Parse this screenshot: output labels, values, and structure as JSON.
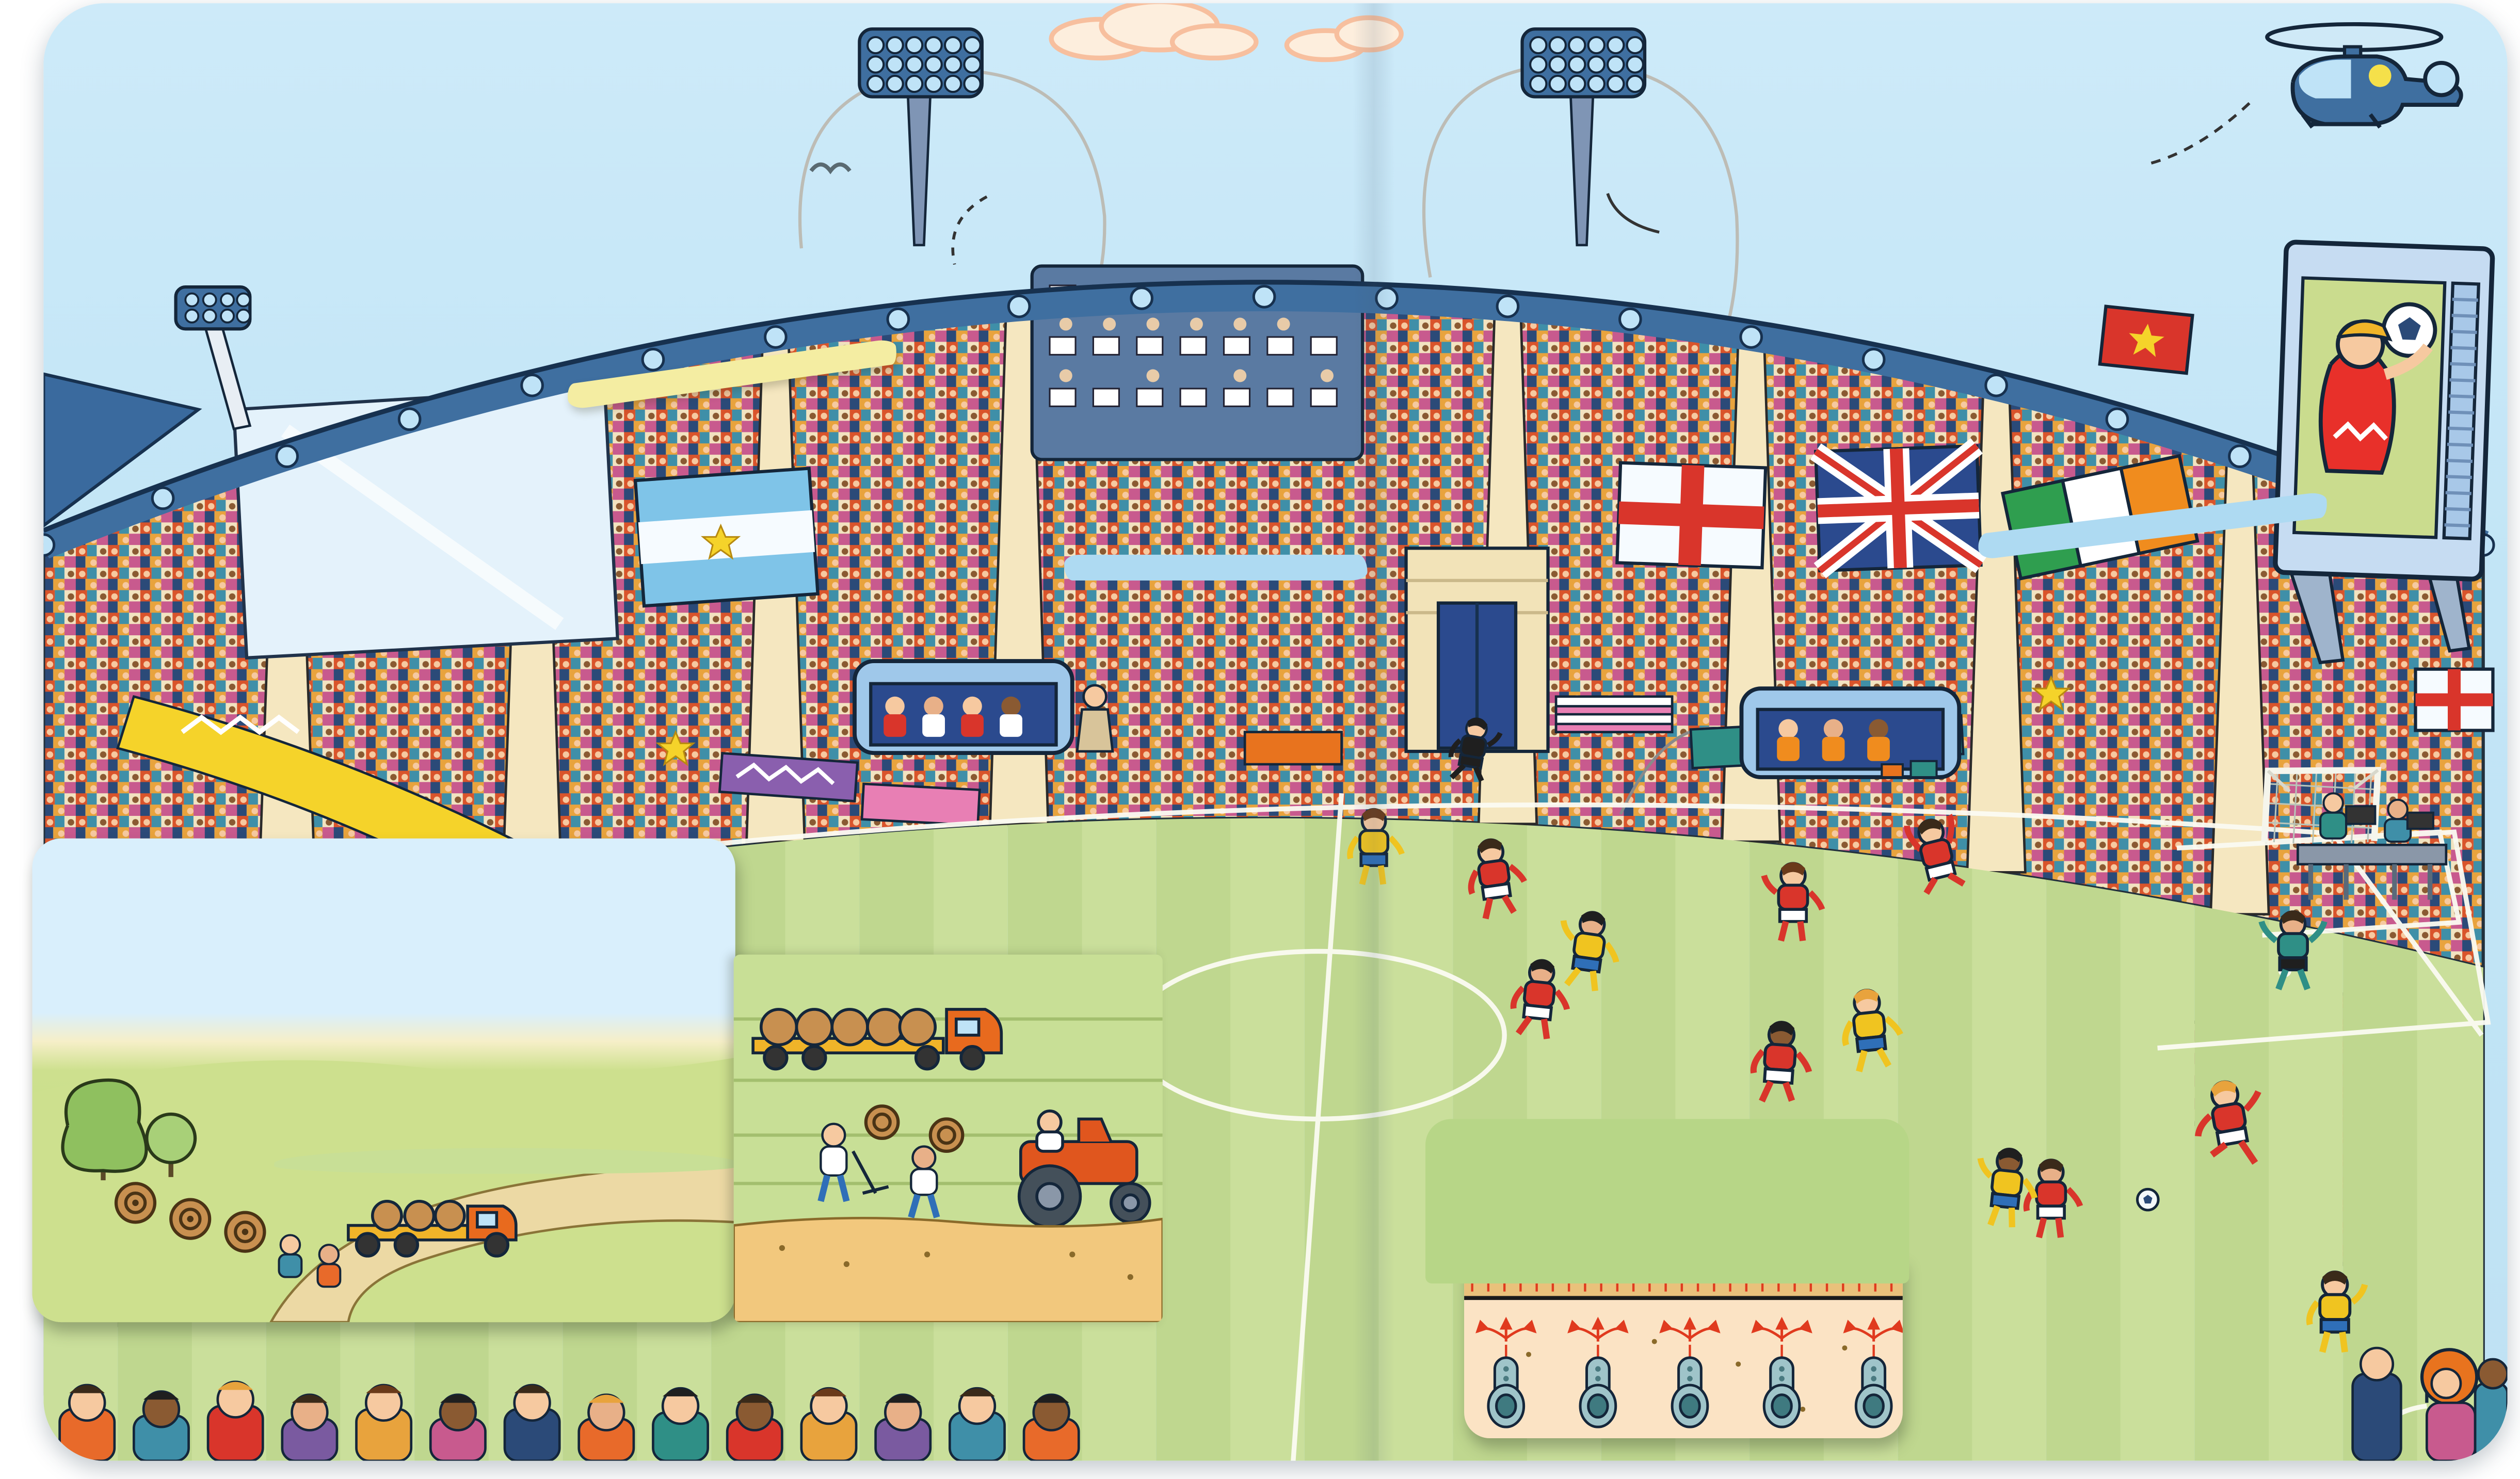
{
  "page": {
    "title": "Im Stadion",
    "intro": "In diesem brandneuen Fußballstadion\nläuft gerade ein packendes Spiel.\nEs ist ganz schön viel los ..."
  },
  "annotations": {
    "reporters": "Reporterinnen und\nReporter verfolgen\ndas Spiel von der\nPressetribüne aus.",
    "floodlight": "Flutlicht-\nanlage für\nSpiele am\nAbend",
    "events": "Große Stadien werden\nauch für Konzerte,\nAutorennen und andere\nVeranstaltungen genutzt.",
    "big_screen": "Auf einem riesigen\nBildschirm laufen\nSzenen des Spiels.",
    "vip_boxes": "Die teuersten\nPlätze sind in\nden Logen.",
    "capacity": "In manche Stadien\npassen mehr als\n90 000 Fans.",
    "team_bench": "Jedes Team hat\neine Bank, auf\nder Spieler und\nTrainer sitzen.",
    "cameras": "Kameras filmen das\nSpiel von allen\nSeiten – sogar mit\neinem Helikopter\naus der Luft.",
    "medics": "Ärzte und Ärztinnen\nstehen bereit, falls\nsich jemand\nverletzt.",
    "turf_growing": "Der Rasen wächst auf Feldern außerhalb\nder Stadt. Er wird mit Kunstfasern verstärkt,\ndamit er länger hält.",
    "turf_transport": "Dann wird er in Streifen\nausgestochen, aufgerollt und\nzum Stadion transportiert.",
    "turf_laying": "Im Stadion werden die Rasen-\nstreifen auf einer Schicht aus\nSchotter und Sand verlegt.",
    "heating": "Heizrohre sorgen dafür, dass das\nGras gut gedeiht. Es gibt auch Rohre\nzur Entwässerung, damit der Boden\nbei Regen nicht zu matschig wird.",
    "shout": "„Schieß!“"
  },
  "colors": {
    "sky": "#c7e7f8",
    "pitch_light": "#cadf9b",
    "pitch_dark": "#bfd78f",
    "note_blue": "#aedaf2",
    "banner_yellow": "#f4eda2",
    "panel_green": "#b7d687",
    "sand": "#f2c87d",
    "flap_peach": "#fbe3c4",
    "rim_blue": "#3f6fa0",
    "team_red": "#d9352b",
    "team_yellow": "#f0c420",
    "accent_red": "#e03a1e"
  }
}
